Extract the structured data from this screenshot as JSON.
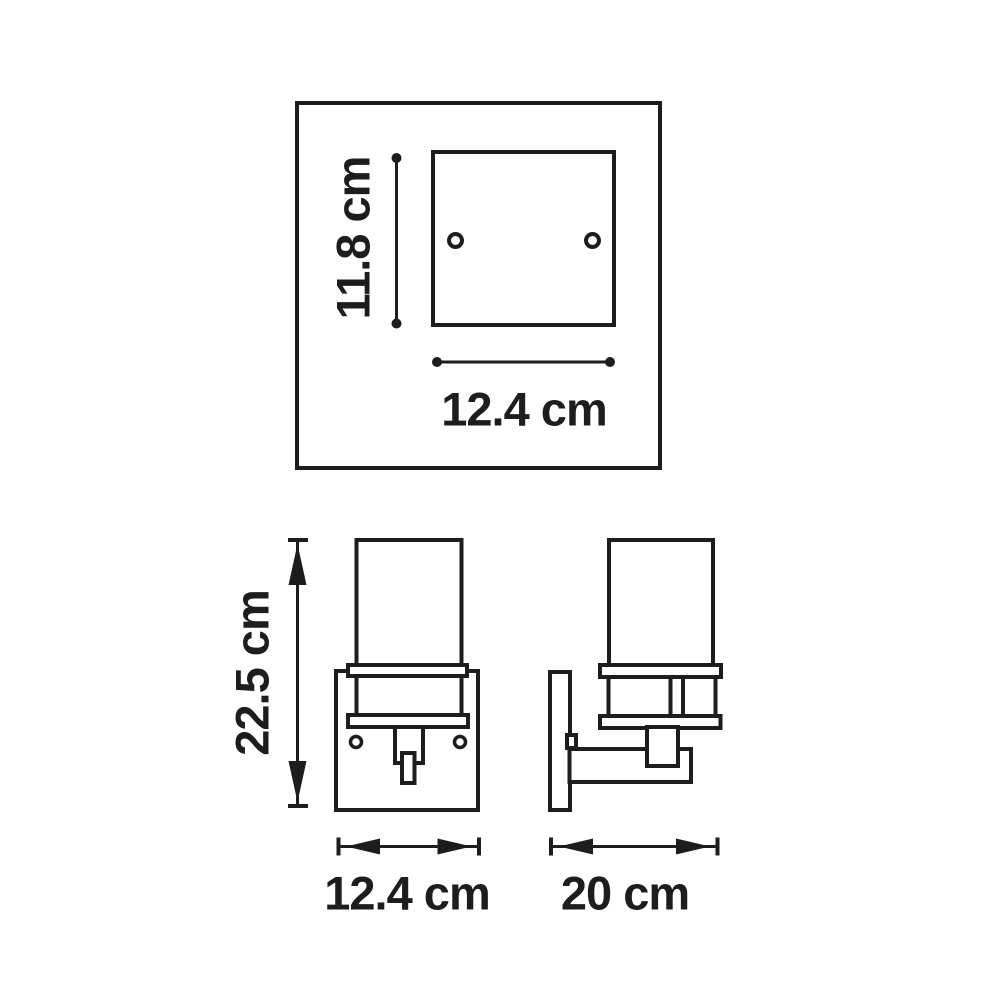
{
  "colors": {
    "background": "#ffffff",
    "line": "#1d1d1b"
  },
  "views": {
    "top": {
      "dim_height": {
        "label": "11.8 cm",
        "value": 11.8,
        "unit": "cm",
        "orientation": "vertical"
      },
      "dim_width": {
        "label": "12.4 cm",
        "value": 12.4,
        "unit": "cm",
        "orientation": "horizontal"
      }
    },
    "front": {
      "dim_height": {
        "label": "22.5 cm",
        "value": 22.5,
        "unit": "cm",
        "orientation": "vertical"
      },
      "dim_width": {
        "label": "12.4 cm",
        "value": 12.4,
        "unit": "cm",
        "orientation": "horizontal"
      }
    },
    "side": {
      "dim_depth": {
        "label": "20 cm",
        "value": 20,
        "unit": "cm",
        "orientation": "horizontal"
      }
    }
  }
}
